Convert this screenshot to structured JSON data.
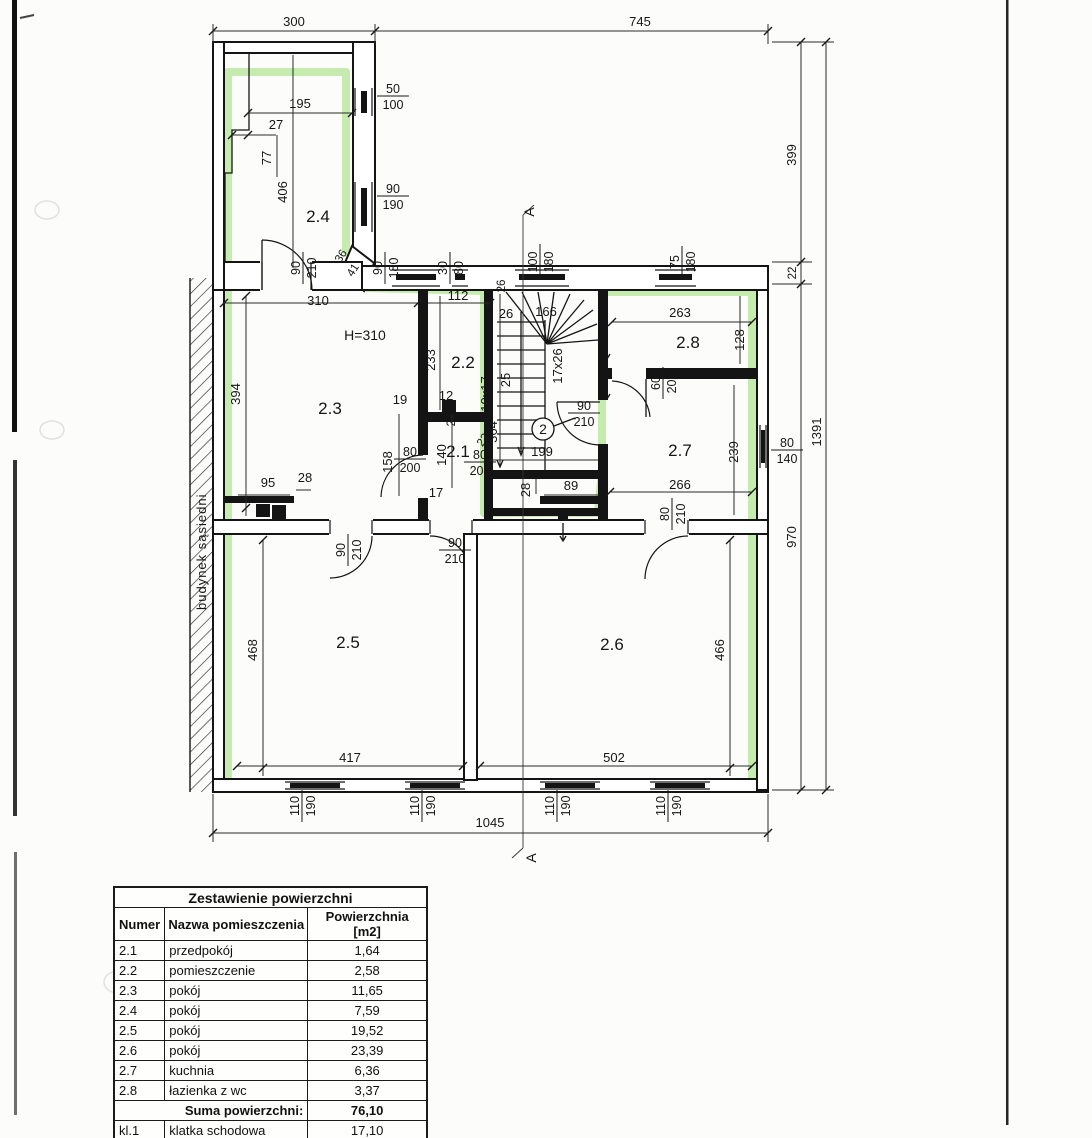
{
  "colors": {
    "highlighter": "#8fd964"
  },
  "plan": {
    "labels": {
      "dim300": "300",
      "dim745": "745",
      "dim195": "195",
      "dim27": "27",
      "dim77": "77",
      "dim406": "406",
      "room24": "2.4",
      "ang36": "36",
      "ang41": "41",
      "dim310": "310",
      "dim112": "112",
      "h310": "H=310",
      "dim233": "233",
      "room22": "2.2",
      "dim394": "394",
      "room23": "2.3",
      "dim19": "19",
      "dim12": "12",
      "dim26c": "26",
      "dim95": "95",
      "dim28a": "28",
      "room21": "2.1",
      "dim158": "158",
      "dim140": "140",
      "dim17": "17",
      "dim199": "199",
      "doorNo": "2",
      "dim28b": "28",
      "dim89": "89",
      "dim364": "364",
      "dim22a": "22",
      "dim26b": "26",
      "dim26d": "26",
      "dim166": "166",
      "stairs1017": "10x17",
      "stairs25": "25",
      "stairs1726": "17x26",
      "dim263": "263",
      "room28": "2.8",
      "dim128": "128",
      "room27": "2.7",
      "dim239": "239",
      "dim266": "266",
      "room25": "2.5",
      "dim468": "468",
      "dim417": "417",
      "room26": "2.6",
      "dim466": "466",
      "dim502": "502",
      "dim1045": "1045",
      "dim399": "399",
      "dim22r": "22",
      "dim970": "970",
      "dim1391": "1391",
      "sectionA_top": "A",
      "sectionA_bot": "A",
      "neighbor": "budynek sąsiedni"
    },
    "fr": {
      "f50_100": {
        "t": "50",
        "b": "100"
      },
      "f90_190": {
        "t": "90",
        "b": "190"
      },
      "f90_210a": {
        "t": "90",
        "b": "210"
      },
      "f90_180": {
        "t": "90",
        "b": "180"
      },
      "f30_80": {
        "t": "30",
        "b": "80"
      },
      "f100_180": {
        "t": "100",
        "b": "180"
      },
      "f75_180": {
        "t": "75",
        "b": "180"
      },
      "f80_200a": {
        "t": "80",
        "b": "200"
      },
      "f80_200b": {
        "t": "80",
        "b": "200"
      },
      "f90_210b": {
        "t": "90",
        "b": "210"
      },
      "f60_200": {
        "t": "60",
        "b": "200"
      },
      "f80_140": {
        "t": "80",
        "b": "140"
      },
      "f80_210a": {
        "t": "80",
        "b": "210"
      },
      "f90_210c": {
        "t": "90",
        "b": "210"
      },
      "f90_210d": {
        "t": "90",
        "b": "210"
      },
      "f110_190a": {
        "t": "110",
        "b": "190"
      },
      "f110_190b": {
        "t": "110",
        "b": "190"
      },
      "f110_190c": {
        "t": "110",
        "b": "190"
      },
      "f110_190d": {
        "t": "110",
        "b": "190"
      }
    }
  },
  "table": {
    "title": "Zestawienie powierzchni",
    "headers": [
      "Numer",
      "Nazwa pomieszczenia",
      "Powierzchnia [m2]"
    ],
    "rows": [
      {
        "num": "2.1",
        "name": "przedpokój",
        "area": "1,64"
      },
      {
        "num": "2.2",
        "name": "pomieszczenie",
        "area": "2,58"
      },
      {
        "num": "2.3",
        "name": "pokój",
        "area": "11,65"
      },
      {
        "num": "2.4",
        "name": "pokój",
        "area": "7,59"
      },
      {
        "num": "2.5",
        "name": "pokój",
        "area": "19,52"
      },
      {
        "num": "2.6",
        "name": "pokój",
        "area": "23,39"
      },
      {
        "num": "2.7",
        "name": "kuchnia",
        "area": "6,36"
      },
      {
        "num": "2.8",
        "name": "łazienka z wc",
        "area": "3,37"
      }
    ],
    "sum_label": "Suma powierzchni:",
    "sum_value": "76,10",
    "extra_row": {
      "num": "kl.1",
      "name": "klatka schodowa",
      "area": "17,10"
    }
  }
}
